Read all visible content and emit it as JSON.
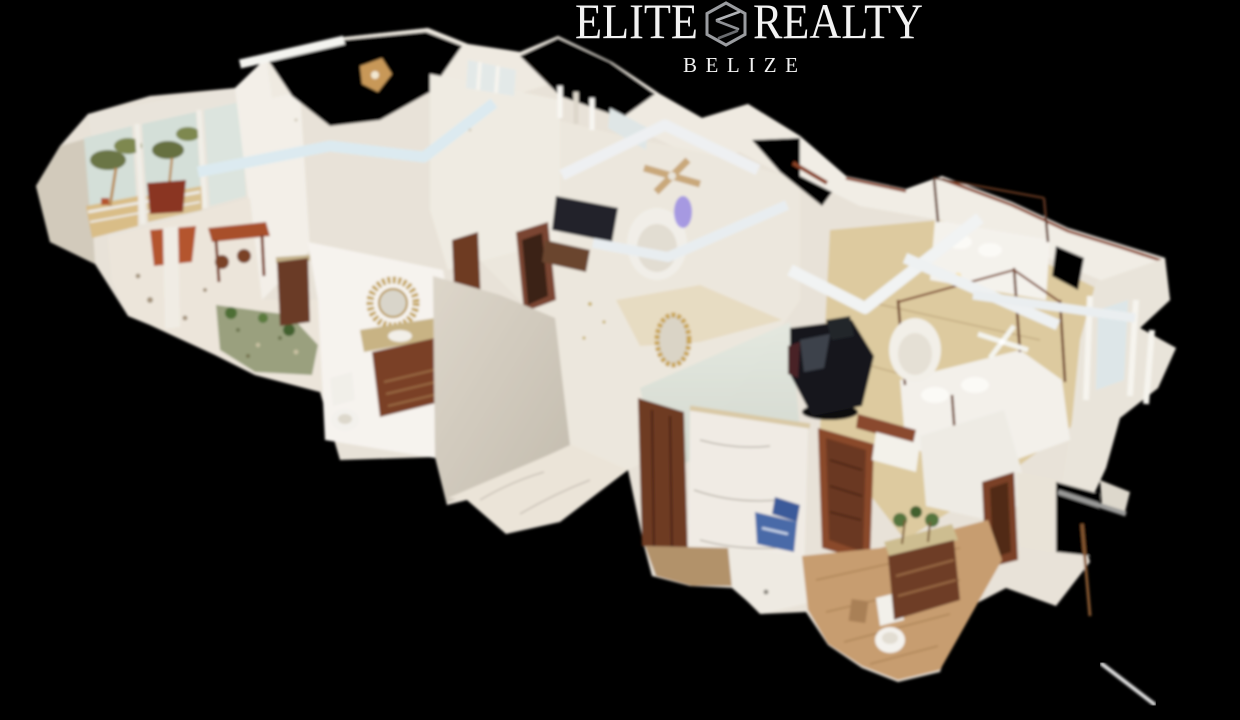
{
  "background_color": "#000000",
  "brand": {
    "wordmark_left": "ELITE",
    "wordmark_right": "REALTY",
    "subtitle": "BELIZE",
    "logo_icon": "hexagon-monogram-icon",
    "text_color": "#f2f2f2",
    "icon_color": "#9a9ca0"
  },
  "scene": {
    "type": "3d-dollhouse-view",
    "description": "Isometric cutaway dollhouse view of a 3D-scanned single-storey villa interior floating on a black background, oriented diagonally from upper-left to lower-right",
    "visible_rooms": [
      "sunroom-dining-with-palm-view",
      "kitchen-bar",
      "hall-bathroom-with-sunburst-mirror",
      "tv-lounge",
      "master-bedroom-four-poster",
      "guest-bedroom",
      "en-suite-marble-bathroom"
    ],
    "visible_objects": [
      "french-windows-palm-view",
      "rust-red-bar-table",
      "bar-stools",
      "granite-counter",
      "pebble-garden-strip",
      "sunburst-mirror",
      "bathroom-vanity",
      "toilet",
      "beige-cutaway-wall",
      "wall-tv",
      "white-armchair",
      "ceiling-fans",
      "gold-framed-mirror",
      "frosted-shower-glass",
      "marble-shower-wall",
      "dark-wood-doors",
      "four-poster-beds",
      "massage-chair",
      "white-ceiling-beams",
      "wood-plank-floor",
      "marble-floor",
      "blue-box",
      "window-curtains",
      "scan-noise-streak"
    ],
    "palette": {
      "background": "#000000",
      "wall_white": "#f0ebe3",
      "wall_shadow": "#d6cfc2",
      "cut_wall_beige": "#d5cec1",
      "beam_blue_white": "#dceaf0",
      "marble_floor": "#efeae2",
      "wood_floor": "#c79d6f",
      "dark_wood": "#6e3a24",
      "rust_furniture": "#a8502c",
      "granite_top": "#c8b384",
      "gold_accent": "#c2a14e",
      "palm_green": "#6b7544",
      "sky_glimpse": "#d4dfd8",
      "sand": "#d9b97e",
      "purple_glow": "#8f7fe2",
      "box_blue": "#4a6aa8",
      "massage_chair_black": "#17181c"
    }
  }
}
